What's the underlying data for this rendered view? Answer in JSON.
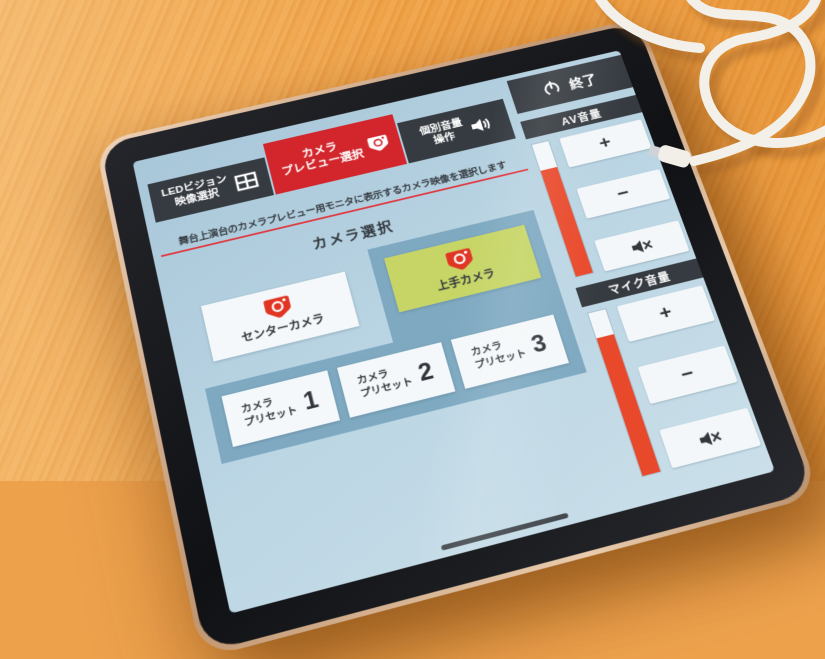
{
  "colors": {
    "accent_red": "#d2262c",
    "volume_bar_red": "#e9492b",
    "group_panel_blue": "#7ea9c1",
    "selected_green": "#c6d565",
    "dark_chrome": "#363b41",
    "screen_background": "#bcd6e4",
    "wood": "#eda14b"
  },
  "header": {
    "tabs": [
      {
        "line1": "LEDビジョン",
        "line2": "映像選択"
      },
      {
        "line1": "カメラ",
        "line2": "プレビュー選択"
      },
      {
        "line1": "個別音量",
        "line2": "操作"
      }
    ],
    "exit_label": "終了"
  },
  "volume_panels": [
    {
      "title": "AV音量",
      "plus": "+",
      "minus": "−",
      "level_percent": 80
    },
    {
      "title": "マイク音量",
      "plus": "+",
      "minus": "−",
      "level_percent": 84
    }
  ],
  "main": {
    "description": "舞台上演台のカメラプレビュー用モニタに表示するカメラ映像を選択します",
    "heading": "カメラ選択",
    "camera_buttons": [
      {
        "label": "センターカメラ",
        "selected": false
      },
      {
        "label": "上手カメラ",
        "selected": true
      }
    ],
    "preset_buttons": [
      {
        "line1": "カメラ",
        "line2": "プリセット",
        "number": "1"
      },
      {
        "line1": "カメラ",
        "line2": "プリセット",
        "number": "2"
      },
      {
        "line1": "カメラ",
        "line2": "プリセット",
        "number": "3"
      }
    ]
  }
}
